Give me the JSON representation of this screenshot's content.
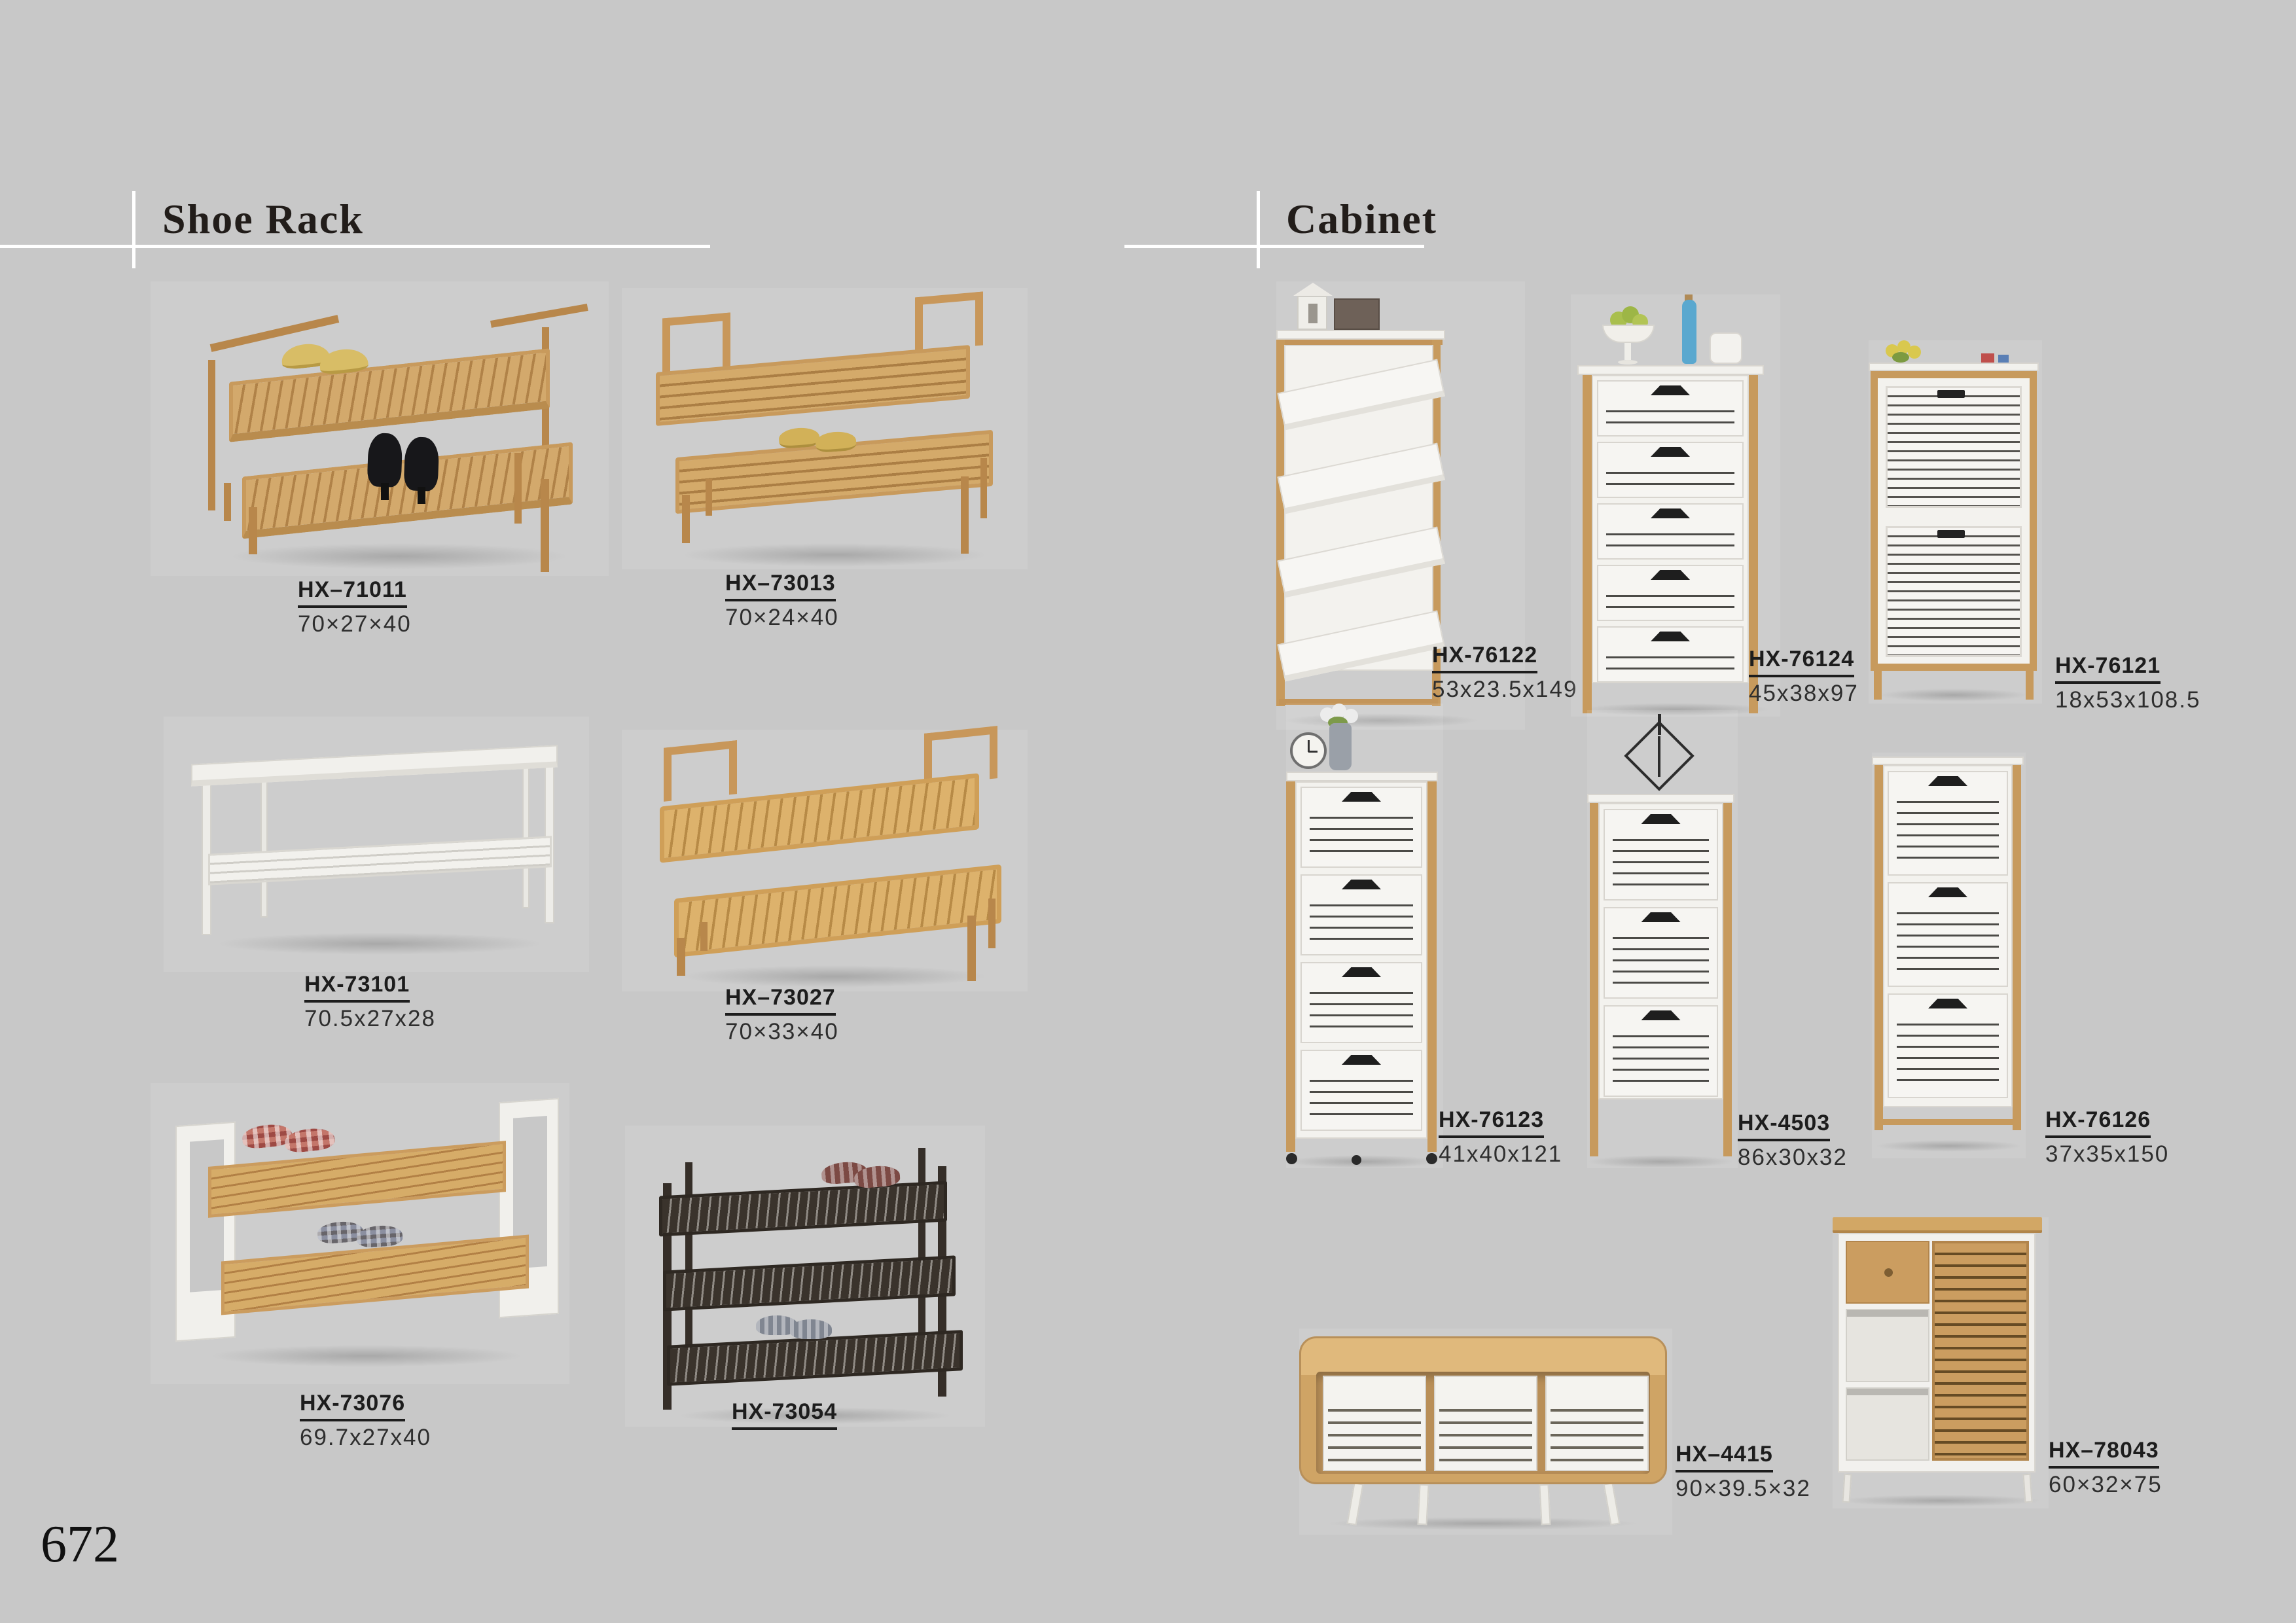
{
  "page": {
    "number": "672"
  },
  "colors": {
    "background": "#c8c8c8",
    "wood": "#c79a5d",
    "white_furniture": "#f3f2ee",
    "label_text": "#1d1d1d"
  },
  "sections": [
    {
      "title": "Shoe Rack",
      "products": [
        {
          "code": "HX–71011",
          "size": "70×27×40"
        },
        {
          "code": "HX–73013",
          "size": "70×24×40"
        },
        {
          "code": "HX-73101",
          "size": "70.5x27x28"
        },
        {
          "code": "HX–73027",
          "size": "70×33×40"
        },
        {
          "code": "HX-73076",
          "size": "69.7x27x40"
        },
        {
          "code": "HX-73054",
          "size": ""
        }
      ]
    },
    {
      "title": "Cabinet",
      "products": [
        {
          "code": "HX-76122",
          "size": "53x23.5x149"
        },
        {
          "code": "HX-76124",
          "size": "45x38x97"
        },
        {
          "code": "HX-76121",
          "size": "18x53x108.5"
        },
        {
          "code": "HX-76123",
          "size": "41x40x121"
        },
        {
          "code": "HX-4503",
          "size": "86x30x32"
        },
        {
          "code": "HX-76126",
          "size": "37x35x150"
        },
        {
          "code": "HX–4415",
          "size": "90×39.5×32"
        },
        {
          "code": "HX–78043",
          "size": "60×32×75"
        }
      ]
    }
  ]
}
